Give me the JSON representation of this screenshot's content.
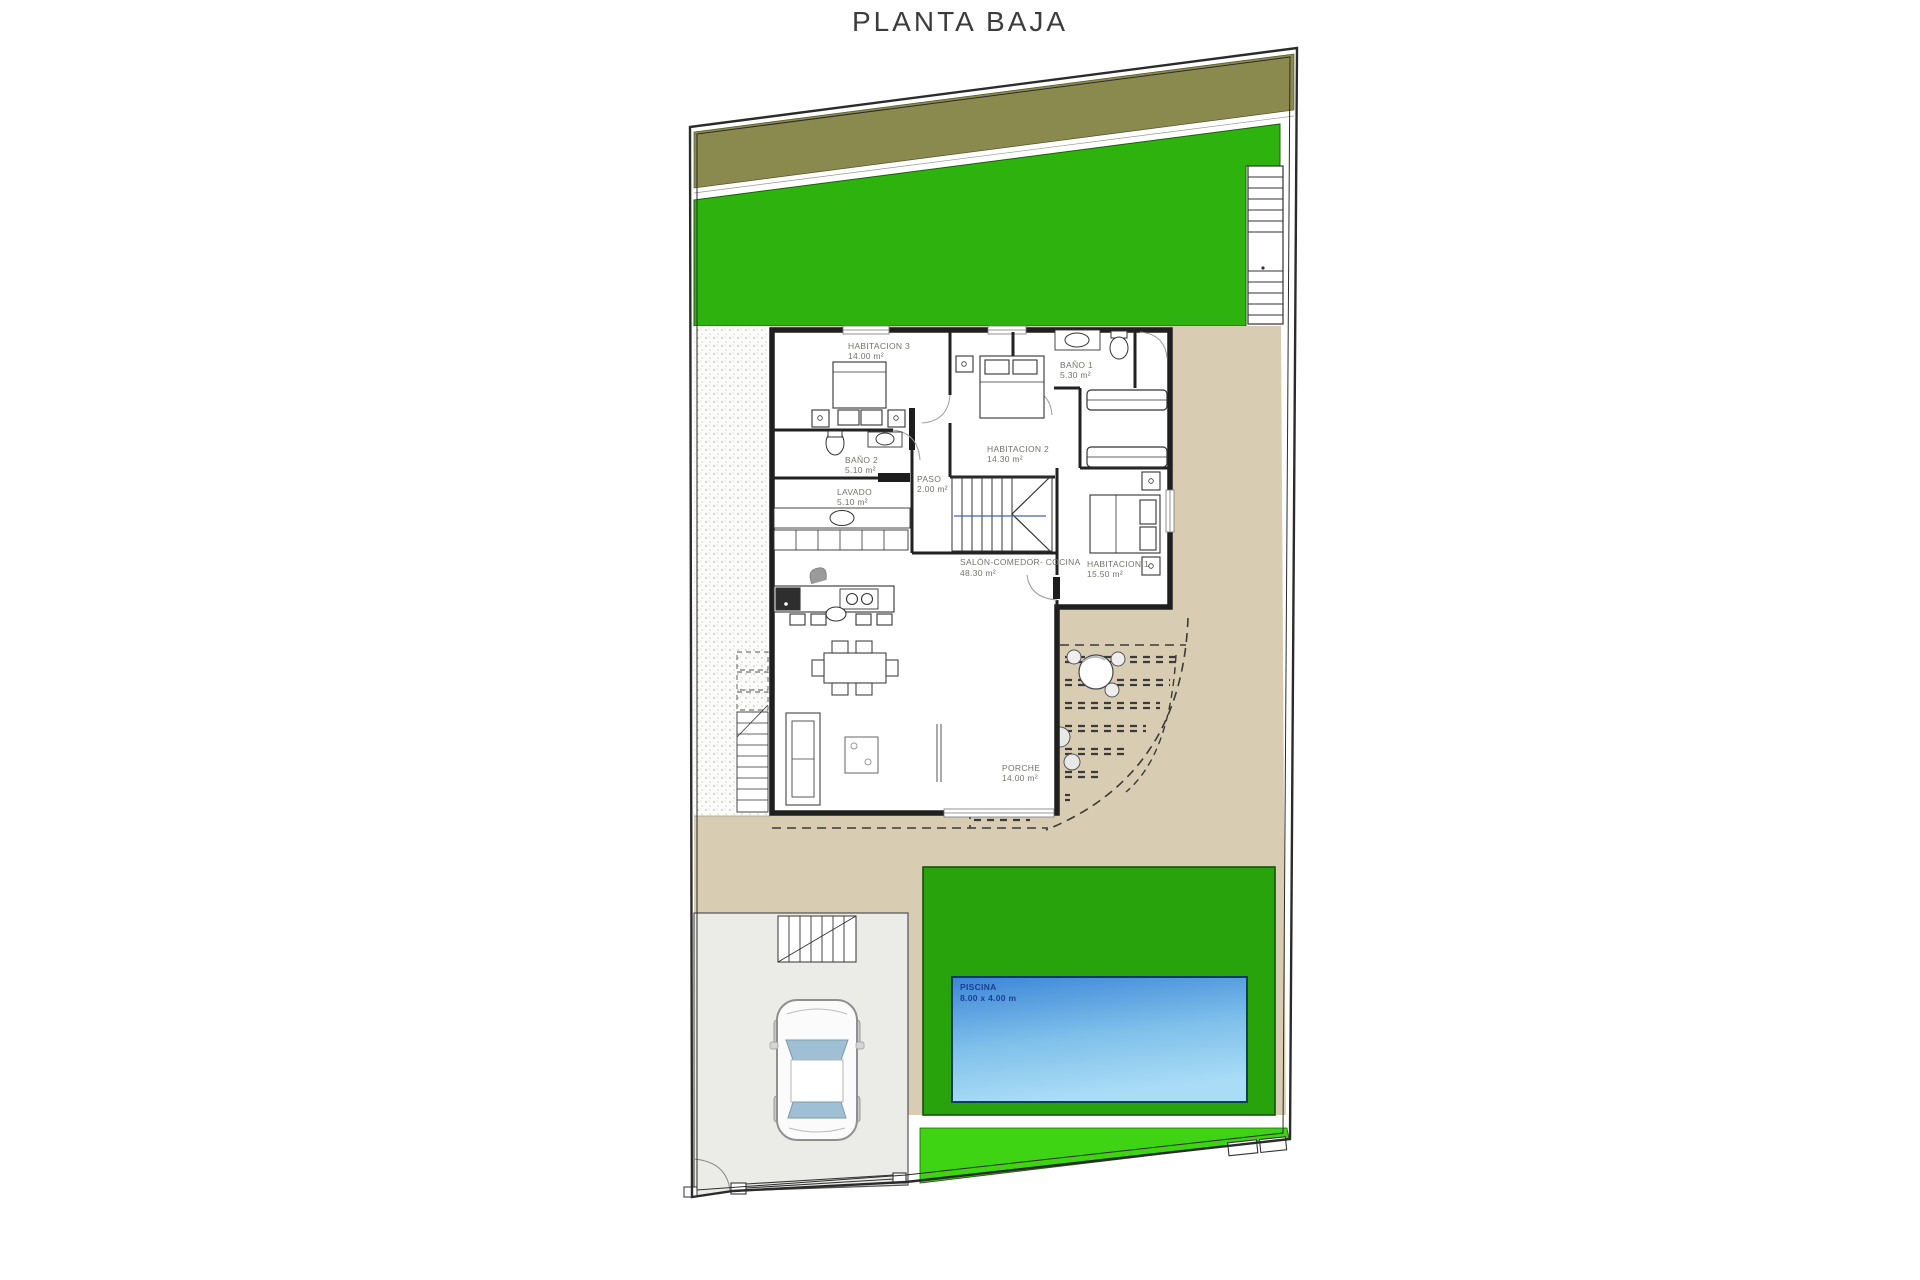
{
  "title": "PLANTA BAJA",
  "rooms": [
    {
      "id": "habitacion3",
      "label": "HABITACION 3",
      "area": "14.00 m²"
    },
    {
      "id": "bano2",
      "label": "BAÑO 2",
      "area": "5.10 m²"
    },
    {
      "id": "paso",
      "label": "PASO",
      "area": "2.00 m²"
    },
    {
      "id": "lavado",
      "label": "LAVADO",
      "area": "5.10 m²"
    },
    {
      "id": "habitacion2",
      "label": "HABITACION 2",
      "area": "14.30 m²"
    },
    {
      "id": "bano1",
      "label": "BAÑO 1",
      "area": "5.30 m²"
    },
    {
      "id": "salon",
      "label": "SALÓN-COMEDOR- COCINA",
      "area": "48.30 m²"
    },
    {
      "id": "habitacion1",
      "label": "HABITACION 1",
      "area": "15.50 m²"
    },
    {
      "id": "porche",
      "label": "PORCHE",
      "area": "14.00 m²"
    },
    {
      "id": "piscina",
      "label": "PISCINA",
      "area": "8.00 x 4.00 m"
    }
  ],
  "colors": {
    "lawn": "#2eb30e",
    "pool_surround": "#28a30c",
    "bottom_grass_strip": "#3ed414",
    "olive_verge": "#8a8a4e",
    "terrace_tan": "#d8cdb2",
    "driveway_gray": "#ebebe8",
    "pool_top": "#3c86d8",
    "pool_bottom": "#aadcf6",
    "pool_label_text": "#1c3f93",
    "walls": "#222222",
    "room_label_text": "#73736a"
  }
}
